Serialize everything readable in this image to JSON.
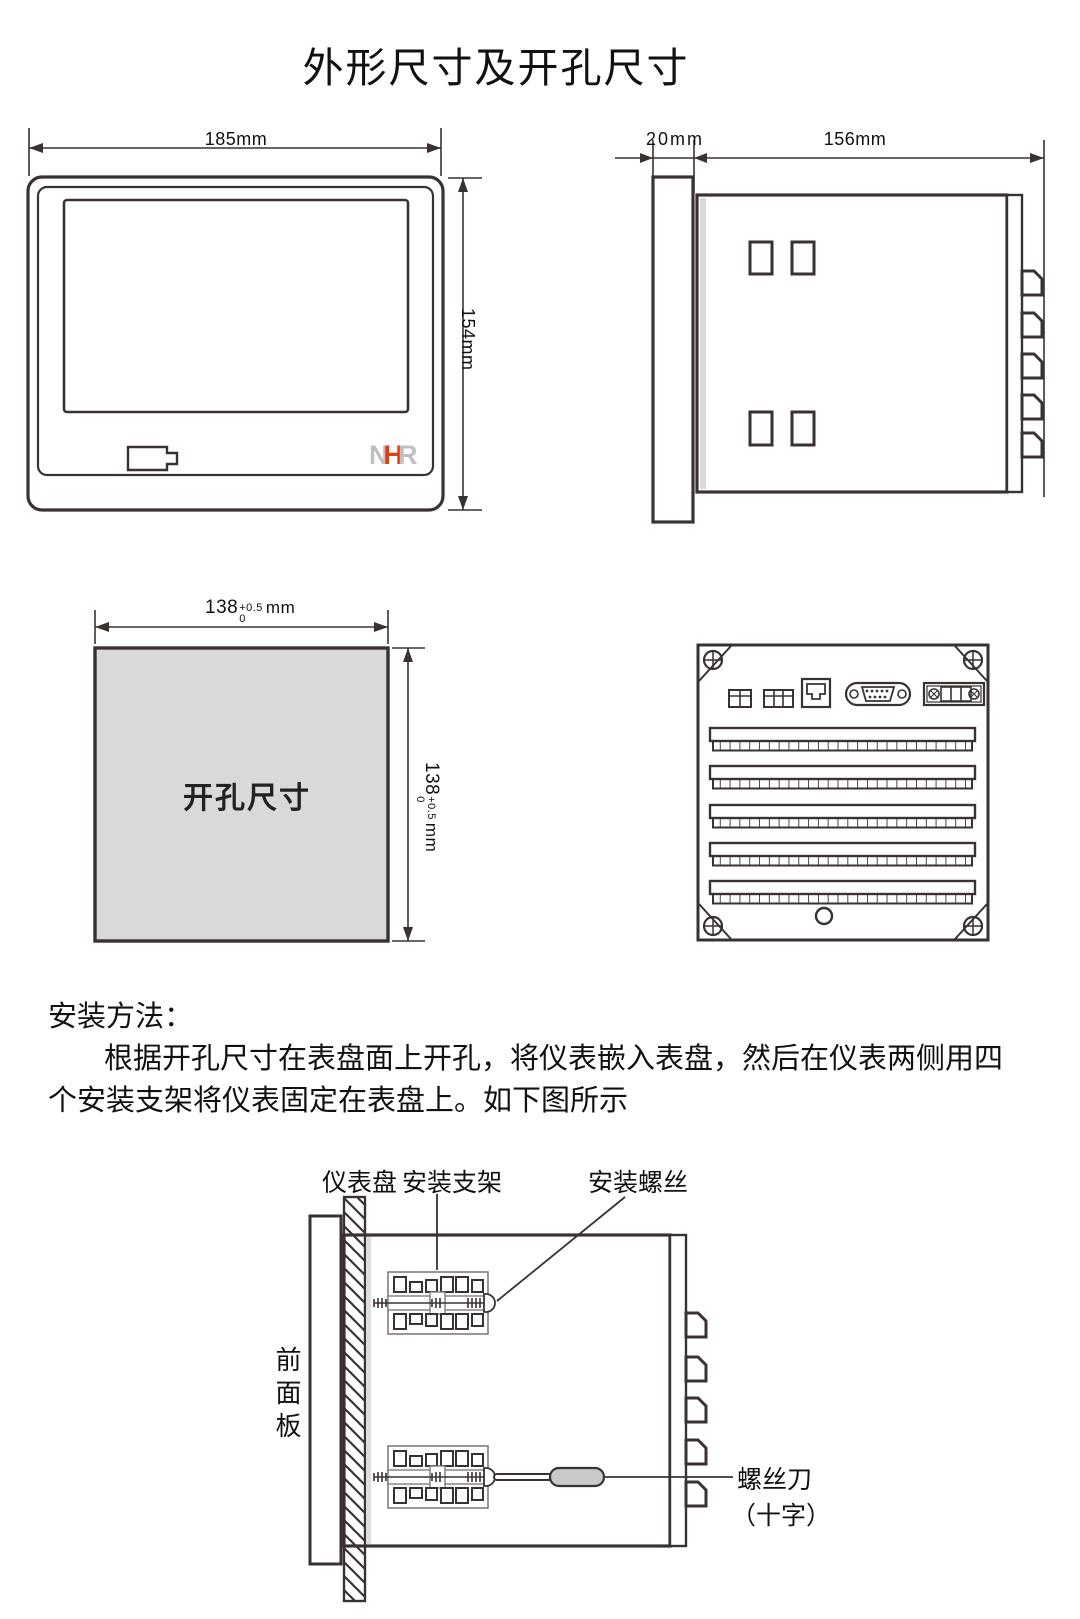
{
  "title": "外形尺寸及开孔尺寸",
  "front_view": {
    "width_dim": "185mm",
    "height_dim": "154mm",
    "logo_n": "N",
    "logo_h": "H",
    "logo_r": "R"
  },
  "side_view": {
    "depth_dim": "20mm",
    "length_dim": "156mm"
  },
  "cutout": {
    "label": "开孔尺寸",
    "value": "138",
    "tol_upper": "+0.5",
    "tol_lower": "0",
    "unit": "mm"
  },
  "install_text": {
    "heading": "安装方法：",
    "line1": "根据开孔尺寸在表盘面上开孔，将仪表嵌入表盘，然后在仪表两侧用四",
    "line2": "个安装支架将仪表固定在表盘上。如下图所示"
  },
  "install_diagram": {
    "label_panel": "仪表盘",
    "label_bracket": "安装支架",
    "label_screw": "安装螺丝",
    "label_front_panel": "前面板",
    "label_screwdriver": "螺丝刀",
    "label_screwdriver_type": "（十字）"
  },
  "colors": {
    "line": "#3a3230",
    "fill_gray": "#d9d9d9",
    "logo_gray": "#bdc1c4",
    "logo_red": "#e23c17"
  }
}
